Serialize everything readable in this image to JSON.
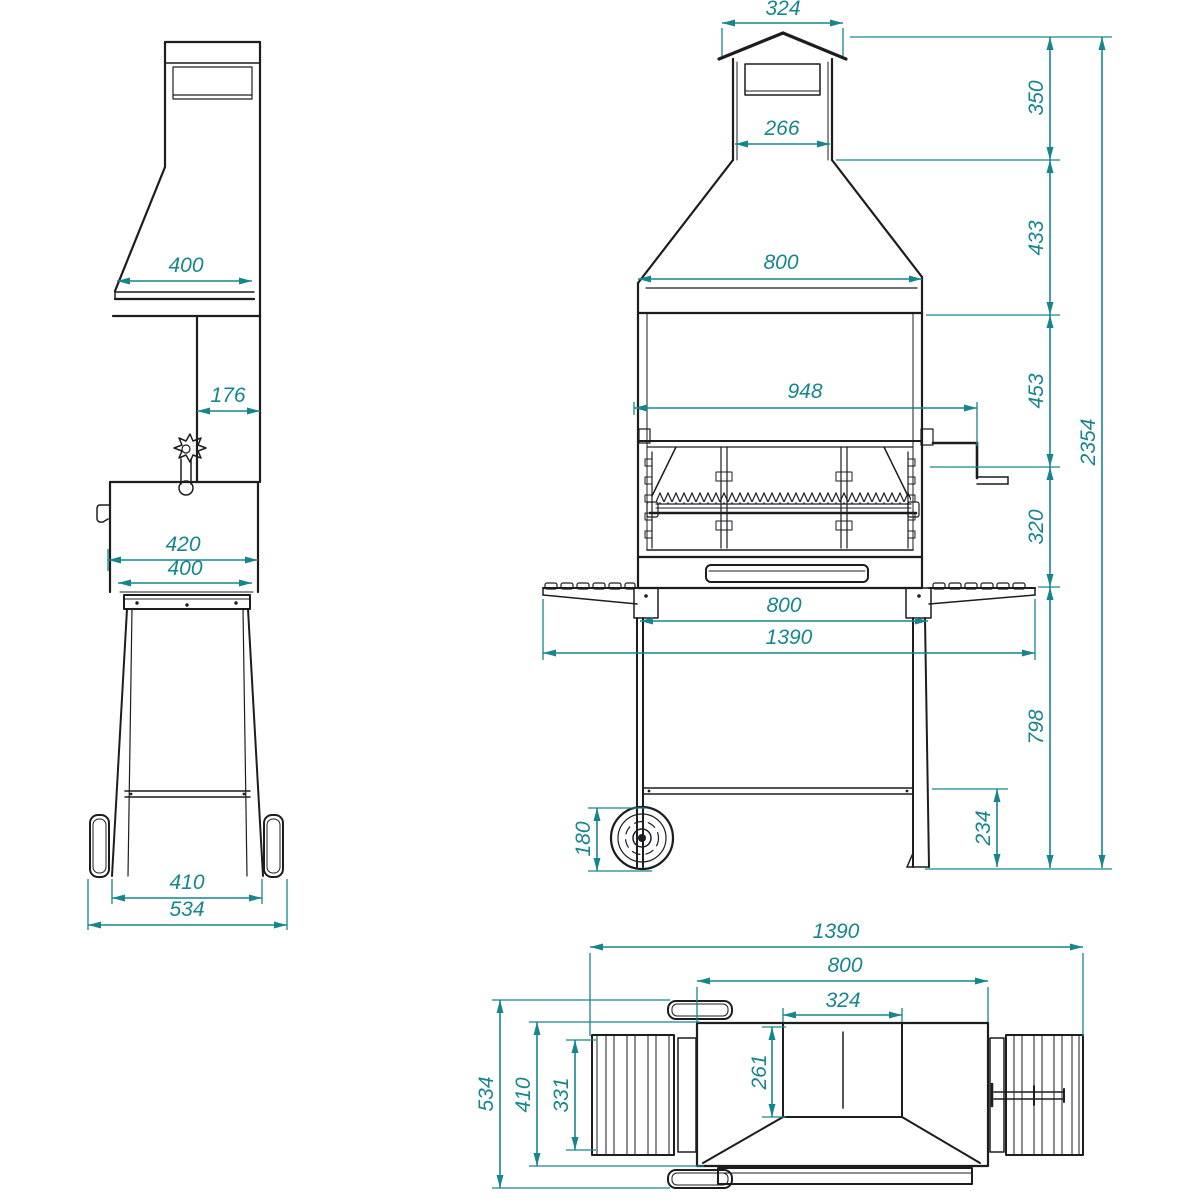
{
  "colors": {
    "dimension": "#17868c",
    "outline": "#1d1d20",
    "background": "#ffffff"
  },
  "views": {
    "side": {
      "dims": {
        "hood_depth": "400",
        "duct_depth": "176",
        "firebox_depth_outer": "420",
        "firebox_depth_inner": "400",
        "leg_stance": "410",
        "overall_depth": "534"
      }
    },
    "front": {
      "dims": {
        "cap_width": "324",
        "cap_height": "350",
        "flue_width": "266",
        "hood_height": "433",
        "hood_width": "800",
        "spit_width": "948",
        "grill_zone_height": "453",
        "under_zone_height": "320",
        "overall_height": "2354",
        "leg_spacing": "800",
        "overall_width": "1390",
        "leg_height": "798",
        "brace_height": "234",
        "wheel_diameter": "180"
      }
    },
    "top": {
      "dims": {
        "overall_width": "1390",
        "body_width": "800",
        "flue_width": "324",
        "flue_depth": "261",
        "shelf_depth": "331",
        "body_depth": "410",
        "overall_depth": "534"
      }
    }
  }
}
